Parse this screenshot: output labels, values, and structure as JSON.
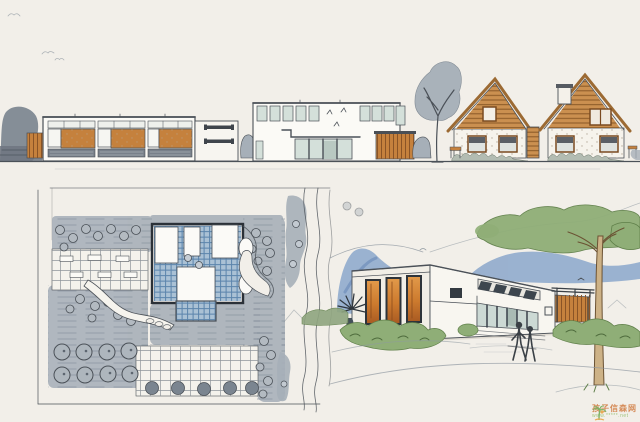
{
  "page": {
    "kind": "scanned hand-drawn architectural presentation sheet",
    "views": {
      "top": "street elevation: low pavilion with timber infill bays, white wall with slot windows, two-storey hall with clerestory glazing, timber canopy, large tree, two timber-gabled cottages",
      "bottom_left": "site plan: grey landscape wash, gridded parking courts, tree circles, courtyard building footprint with blue glazed courts, winding footpath, river with banks",
      "bottom_right": "perspective sketch: flat-roof building with orange glowing bays, angled clerestory over glazed entrance, timber slat screen, tall tree, blue hill, shrubs and two figures"
    }
  },
  "watermark": {
    "icon": "palm-tree-logo-icon",
    "text": "孩子信森网",
    "url": "www.*****.net"
  },
  "palette": {
    "paper": "#f2efe9",
    "ink": "#4b5158",
    "ink_light": "#9099a1",
    "gray_wash": "#a6afb8",
    "gray_dark": "#7e8892",
    "wood": "#c5813d",
    "wood_dark": "#8a5426",
    "wood_light": "#cb9050",
    "glass": "#d4e0da",
    "glass_blue": "#aac1d5",
    "hatch_blue": "#5b84ac",
    "hill_blue": "#8ba7cb",
    "green": "#8fae77",
    "green_dark": "#5f7f49",
    "trunk_tan": "#cdb287",
    "wm_text": "#d07a3f",
    "wm_url": "#93bd6b"
  }
}
